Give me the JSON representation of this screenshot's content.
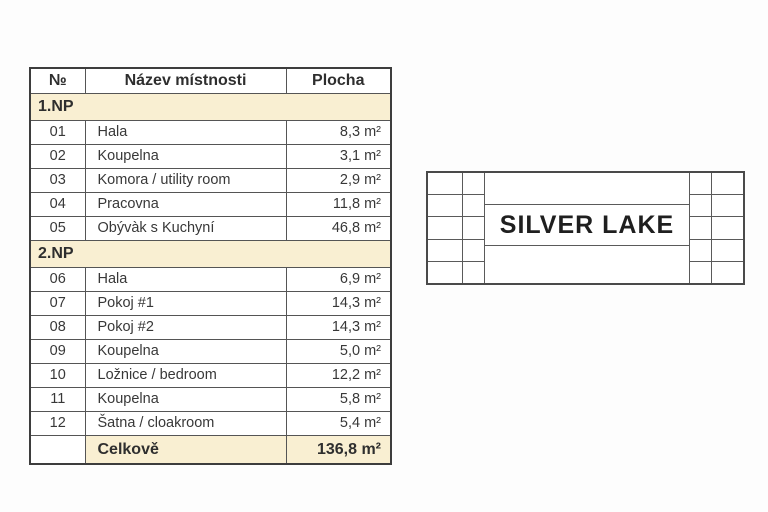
{
  "table": {
    "header": {
      "num": "№",
      "name": "Název místnosti",
      "area": "Plocha"
    },
    "sections": [
      {
        "label": "1.NP",
        "rows": [
          {
            "num": "01",
            "name": "Hala",
            "area": "8,3 m²"
          },
          {
            "num": "02",
            "name": "Koupelna",
            "area": "3,1 m²"
          },
          {
            "num": "03",
            "name": "Komora / utility room",
            "area": "2,9 m²"
          },
          {
            "num": "04",
            "name": "Pracovna",
            "area": "11,8 m²"
          },
          {
            "num": "05",
            "name": "Obývàk s Kuchyní",
            "area": "46,8 m²"
          }
        ]
      },
      {
        "label": "2.NP",
        "rows": [
          {
            "num": "06",
            "name": "Hala",
            "area": "6,9 m²"
          },
          {
            "num": "07",
            "name": "Pokoj #1",
            "area": "14,3 m²"
          },
          {
            "num": "08",
            "name": "Pokoj #2",
            "area": "14,3 m²"
          },
          {
            "num": "09",
            "name": "Koupelna",
            "area": "5,0 m²"
          },
          {
            "num": "10",
            "name": "Ložnice / bedroom",
            "area": "12,2 m²"
          },
          {
            "num": "11",
            "name": "Koupelna",
            "area": "5,8 m²"
          },
          {
            "num": "12",
            "name": "Šatna / cloakroom",
            "area": "5,4 m²"
          }
        ]
      }
    ],
    "total": {
      "label": "Celkově",
      "area": "136,8 m²"
    },
    "colors": {
      "section_bg": "#f9efd2",
      "border": "#4a4a4a",
      "text": "#383838"
    }
  },
  "logo": {
    "title": "SILVER LAKE"
  }
}
